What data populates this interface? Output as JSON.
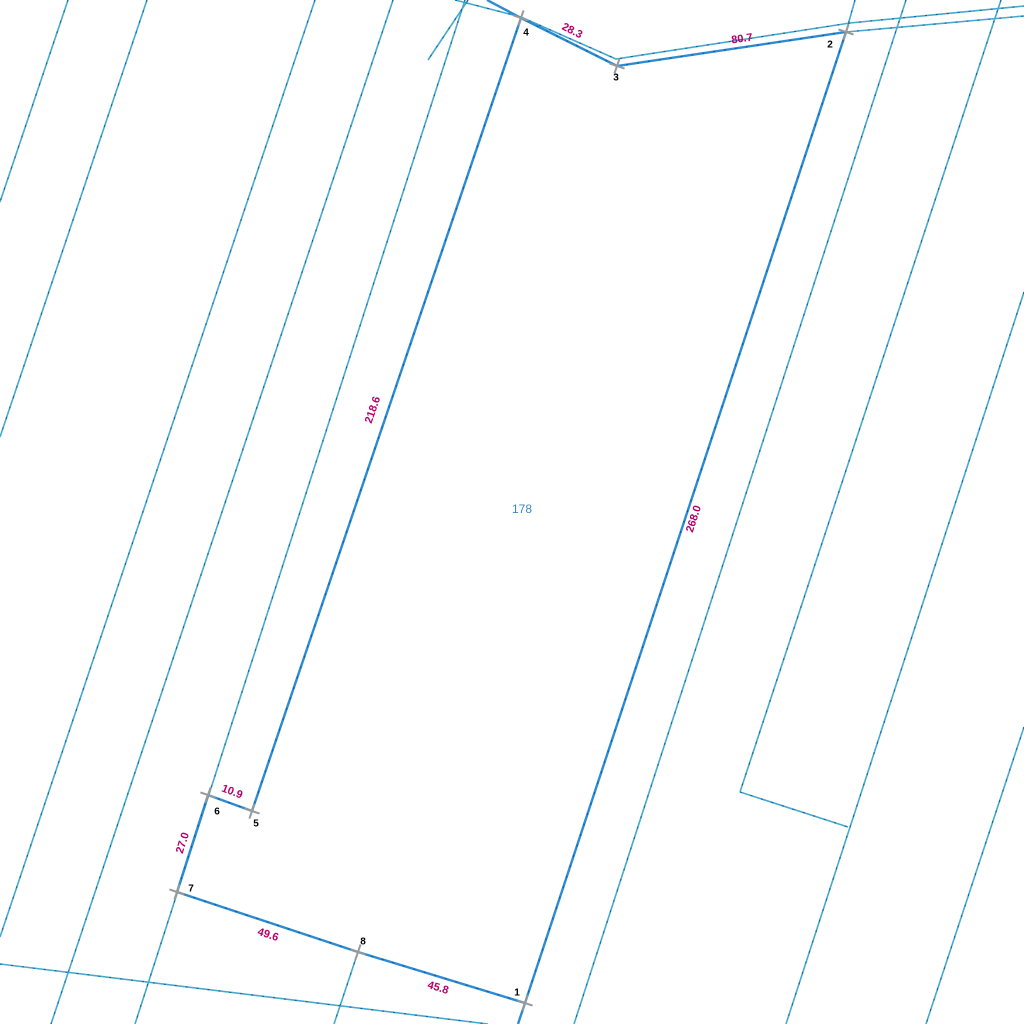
{
  "canvas": {
    "width": 1024,
    "height": 1024,
    "background": "#ffffff"
  },
  "colors": {
    "boundary_cyan": "#46aacf",
    "parcel_blue": "#2b8bd4",
    "dash_overlay": "#1b4d7e",
    "dimension_magenta": "#b5006a",
    "parcel_number_blue": "#3d87c8",
    "marker_gray": "#999999",
    "vertex_text": "#000000"
  },
  "stroke": {
    "cyan_width": 1.6,
    "blue_width": 2.4,
    "dash_width": 0.9,
    "cross_width": 2,
    "cross_arm": 8,
    "cross_rotation": 19
  },
  "parcel": {
    "number": "178",
    "label_pos": {
      "x": 522,
      "y": 509
    },
    "vertices": [
      {
        "n": "1",
        "x": 525,
        "y": 1003,
        "label": {
          "x": 517,
          "y": 993
        }
      },
      {
        "n": "2",
        "x": 846,
        "y": 32,
        "label": {
          "x": 830,
          "y": 45
        }
      },
      {
        "n": "3",
        "x": 617,
        "y": 66,
        "label": {
          "x": 616,
          "y": 78
        }
      },
      {
        "n": "4",
        "x": 521,
        "y": 18,
        "label": {
          "x": 526,
          "y": 33
        }
      },
      {
        "n": "5",
        "x": 252,
        "y": 811,
        "label": {
          "x": 256,
          "y": 824
        }
      },
      {
        "n": "6",
        "x": 208,
        "y": 795,
        "label": {
          "x": 217,
          "y": 812
        }
      },
      {
        "n": "7",
        "x": 177,
        "y": 892,
        "label": {
          "x": 191,
          "y": 889
        }
      },
      {
        "n": "8",
        "x": 358,
        "y": 952,
        "label": {
          "x": 363,
          "y": 942
        }
      }
    ],
    "edges": [
      {
        "from": "1",
        "to": "2",
        "length": "268.0",
        "label": {
          "x": 694,
          "y": 519,
          "rot": -72
        }
      },
      {
        "from": "2",
        "to": "3",
        "length": "80.7",
        "label": {
          "x": 742,
          "y": 39,
          "rot": -8
        }
      },
      {
        "from": "3",
        "to": "4",
        "length": "28.3",
        "label": {
          "x": 572,
          "y": 31,
          "rot": 27
        }
      },
      {
        "from": "4",
        "to": "5",
        "length": "218.6",
        "label": {
          "x": 373,
          "y": 410,
          "rot": -71
        }
      },
      {
        "from": "5",
        "to": "6",
        "length": "10.9",
        "label": {
          "x": 232,
          "y": 792,
          "rot": 21
        }
      },
      {
        "from": "6",
        "to": "7",
        "length": "27.0",
        "label": {
          "x": 183,
          "y": 843,
          "rot": -72
        }
      },
      {
        "from": "7",
        "to": "8",
        "length": "49.6",
        "label": {
          "x": 268,
          "y": 935,
          "rot": 18
        }
      },
      {
        "from": "8",
        "to": "1",
        "length": "45.8",
        "label": {
          "x": 438,
          "y": 988,
          "rot": 17
        }
      }
    ],
    "extensions": [
      {
        "points": [
          [
            487,
            0
          ],
          [
            521,
            18
          ]
        ]
      },
      {
        "points": [
          [
            525,
            1003
          ],
          [
            518,
            1024
          ]
        ]
      }
    ]
  },
  "background_lines": [
    {
      "points": [
        [
          68,
          0
        ],
        [
          0,
          202
        ]
      ]
    },
    {
      "points": [
        [
          147,
          0
        ],
        [
          0,
          437
        ]
      ]
    },
    {
      "points": [
        [
          315,
          0
        ],
        [
          0,
          937
        ]
      ]
    },
    {
      "points": [
        [
          393,
          0
        ],
        [
          51,
          1024
        ]
      ]
    },
    {
      "points": [
        [
          465,
          0
        ],
        [
          135,
          1024
        ]
      ]
    },
    {
      "points": [
        [
          906,
          0
        ],
        [
          574,
          1024
        ]
      ]
    },
    {
      "points": [
        [
          1001,
          0
        ],
        [
          740,
          792
        ]
      ]
    },
    {
      "points": [
        [
          1024,
          292
        ],
        [
          786,
          1024
        ]
      ]
    },
    {
      "points": [
        [
          740,
          792
        ],
        [
          848,
          827
        ]
      ]
    },
    {
      "points": [
        [
          1024,
          727
        ],
        [
          926,
          1024
        ]
      ]
    },
    {
      "points": [
        [
          358,
          952
        ],
        [
          334,
          1024
        ]
      ]
    },
    {
      "points": [
        [
          0,
          964
        ],
        [
          488,
          1024
        ]
      ]
    },
    {
      "points": [
        [
          468,
          0
        ],
        [
          428,
          60
        ]
      ]
    },
    {
      "points": [
        [
          855,
          0
        ],
        [
          846,
          32
        ]
      ]
    },
    {
      "points": [
        [
          455,
          0
        ],
        [
          521,
          17
        ],
        [
          616,
          59
        ],
        [
          850,
          23
        ],
        [
          1024,
          6
        ]
      ]
    },
    {
      "points": [
        [
          846,
          32
        ],
        [
          1024,
          16
        ]
      ]
    }
  ]
}
